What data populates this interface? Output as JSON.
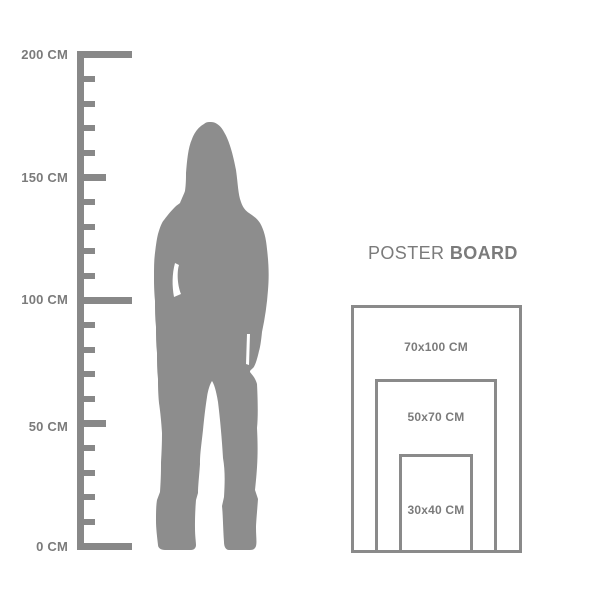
{
  "colors": {
    "background": "#ffffff",
    "text": "#7b7b7b",
    "ruler": "#888888",
    "rect_border": "#8a8a8a",
    "silhouette": "#8d8d8d"
  },
  "ruler": {
    "unit": "CM",
    "range_cm": [
      0,
      200
    ],
    "labels": [
      {
        "cm": 200,
        "text": "200 CM"
      },
      {
        "cm": 150,
        "text": "150 CM"
      },
      {
        "cm": 100,
        "text": "100 CM"
      },
      {
        "cm": 50,
        "text": "50 CM"
      },
      {
        "cm": 0,
        "text": "0 CM"
      }
    ],
    "major_ticks_cm": [
      200,
      100,
      0
    ],
    "mid_ticks_cm": [
      150,
      50
    ],
    "minor_tick_step_cm": 10
  },
  "figure": {
    "name": "standing-woman-silhouette"
  },
  "poster_board": {
    "title": {
      "regular": "POSTER",
      "bold": "BOARD"
    },
    "sizes": [
      {
        "label": "70x100 CM",
        "width_cm": 70,
        "height_cm": 100
      },
      {
        "label": "50x70 CM",
        "width_cm": 50,
        "height_cm": 70
      },
      {
        "label": "30x40 CM",
        "width_cm": 30,
        "height_cm": 40
      }
    ]
  }
}
